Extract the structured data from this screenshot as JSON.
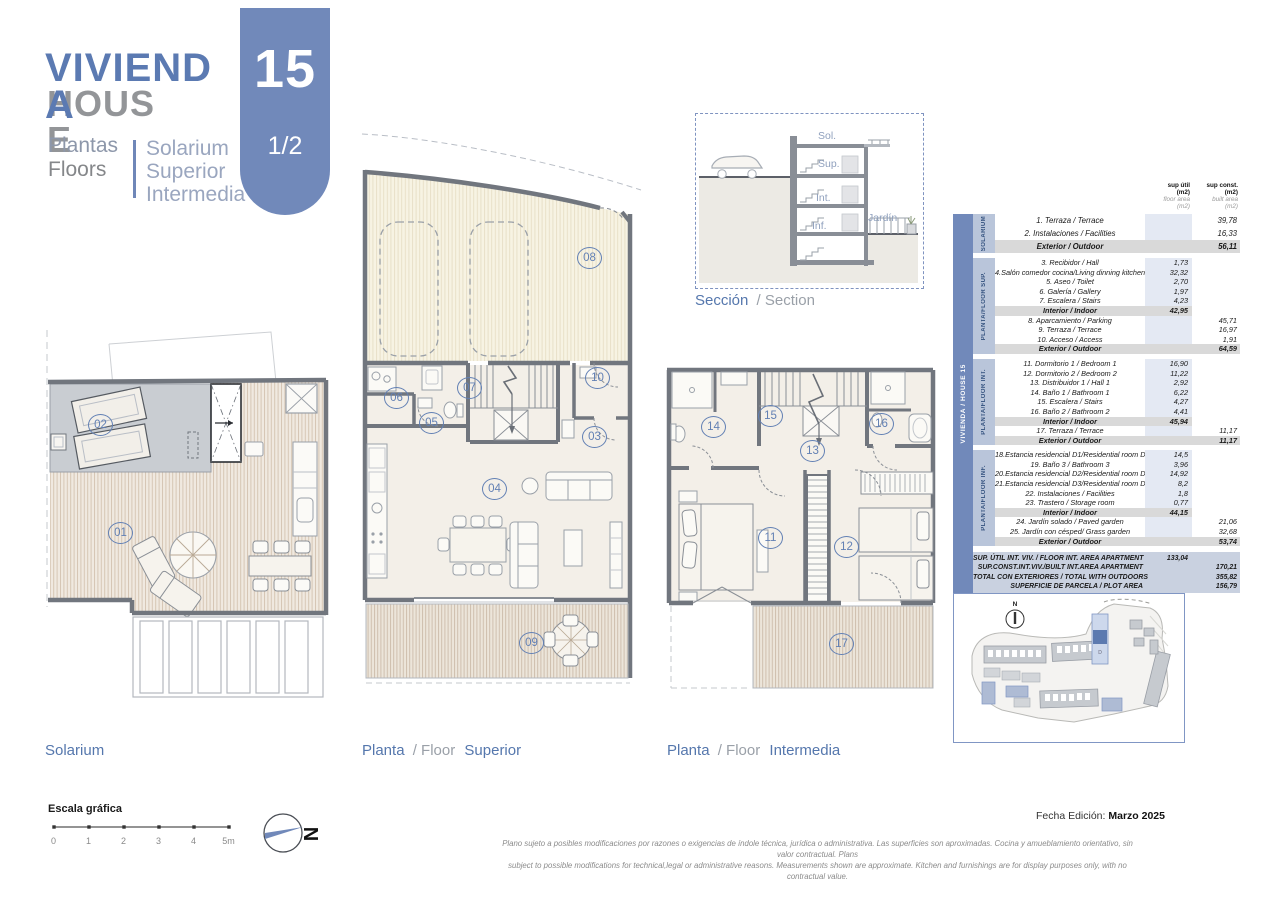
{
  "colors": {
    "accent_blue": "#5b7ab2",
    "tab_blue": "#7189ba",
    "gray_text": "#939598",
    "table_section_blue": "#b9c5da",
    "subtotal_gray": "#d9d9d9",
    "summary_blue": "#c9d1e0",
    "circle_blue": "#6280b4",
    "deck_stripe": "#cfbfae",
    "wall_gray": "#71767e"
  },
  "header": {
    "title_es": "VIVIENDA",
    "title_en": "HOUSE",
    "subtitle_es": "Plantas",
    "subtitle_en": "Floors",
    "floors": [
      "Solarium",
      "Superior",
      "Intermedia"
    ],
    "unit_number": "15",
    "page": "1/2"
  },
  "section_drawing": {
    "labels": {
      "sol": "Sol.",
      "sup": "Sup.",
      "int": "Int.",
      "inf": "Inf.",
      "jardin": "Jardín"
    },
    "caption_es": "Sección",
    "caption_rest": "/ Section"
  },
  "plans": [
    {
      "id": "solarium",
      "caption": {
        "es": "Solarium",
        "mid": "",
        "name": ""
      },
      "circles": [
        {
          "n": "01",
          "x": 65,
          "y": 200
        },
        {
          "n": "02",
          "x": 45,
          "y": 92
        }
      ]
    },
    {
      "id": "superior",
      "caption": {
        "es": "Planta",
        "mid": "/ Floor",
        "name": "Superior"
      },
      "circles": [
        {
          "n": "03",
          "x": 224,
          "y": 300
        },
        {
          "n": "04",
          "x": 124,
          "y": 352
        },
        {
          "n": "05",
          "x": 61,
          "y": 286
        },
        {
          "n": "06",
          "x": 26,
          "y": 261
        },
        {
          "n": "07",
          "x": 99,
          "y": 251
        },
        {
          "n": "08",
          "x": 219,
          "y": 121
        },
        {
          "n": "09",
          "x": 161,
          "y": 506
        },
        {
          "n": "10",
          "x": 227,
          "y": 241
        }
      ]
    },
    {
      "id": "intermedia",
      "caption": {
        "es": "Planta",
        "mid": "/ Floor",
        "name": "Intermedia"
      },
      "circles": [
        {
          "n": "11",
          "x": 95,
          "y": 169
        },
        {
          "n": "12",
          "x": 171,
          "y": 178
        },
        {
          "n": "13",
          "x": 137,
          "y": 82
        },
        {
          "n": "14",
          "x": 38,
          "y": 58
        },
        {
          "n": "15",
          "x": 95,
          "y": 47
        },
        {
          "n": "16",
          "x": 206,
          "y": 55
        },
        {
          "n": "17",
          "x": 166,
          "y": 275
        }
      ]
    }
  ],
  "table": {
    "side_label": "VIVIENDA / HOUSE 15",
    "col_headers": [
      {
        "title": "sup útil",
        "unit": "(m2)",
        "sub": "floor area",
        "sub_unit": "(m2)"
      },
      {
        "title": "sup const.",
        "unit": "(m2)",
        "sub": "built area",
        "sub_unit": "(m2)"
      }
    ],
    "sections": [
      {
        "bar": "SOLARIUM",
        "rows": [
          {
            "l": "1. Terraza / Terrace",
            "u": "",
            "c": "39,78",
            "sub": ""
          },
          {
            "l": "2. Instalaciones / Facilities",
            "u": "",
            "c": "16,33",
            "sub": ""
          },
          {
            "l": "Exterior / Outdoor",
            "u": "",
            "c": "56,11",
            "sub": "ex"
          }
        ]
      },
      {
        "bar": "PLANTA/FLOOR SUP.",
        "rows": [
          {
            "l": "3. Recibidor / Hall",
            "u": "1,73",
            "c": "",
            "sub": ""
          },
          {
            "l": "4.Salón comedor cocina/Living dinning kitchen",
            "u": "32,32",
            "c": "",
            "sub": ""
          },
          {
            "l": "5. Aseo / Toilet",
            "u": "2,70",
            "c": "",
            "sub": ""
          },
          {
            "l": "6. Galería / Gallery",
            "u": "1,97",
            "c": "",
            "sub": ""
          },
          {
            "l": "7. Escalera / Stairs",
            "u": "4,23",
            "c": "",
            "sub": ""
          },
          {
            "l": "Interior / Indoor",
            "u": "42,95",
            "c": "",
            "sub": "in"
          },
          {
            "l": "8. Aparcamiento / Parking",
            "u": "",
            "c": "45,71",
            "sub": ""
          },
          {
            "l": "9. Terraza / Terrace",
            "u": "",
            "c": "16,97",
            "sub": ""
          },
          {
            "l": "10. Acceso / Access",
            "u": "",
            "c": "1,91",
            "sub": ""
          },
          {
            "l": "Exterior / Outdoor",
            "u": "",
            "c": "64,59",
            "sub": "ex"
          }
        ]
      },
      {
        "bar": "PLANTA/FLOOR INT.",
        "rows": [
          {
            "l": "11. Dormitorio 1 / Bedroom 1",
            "u": "16,90",
            "c": "",
            "sub": ""
          },
          {
            "l": "12.  Dormitorio 2 / Bedroom 2",
            "u": "11,22",
            "c": "",
            "sub": ""
          },
          {
            "l": "13. Distribuidor 1 / Hall 1",
            "u": "2,92",
            "c": "",
            "sub": ""
          },
          {
            "l": "14. Baño 1 / Bathroom 1",
            "u": "6,22",
            "c": "",
            "sub": ""
          },
          {
            "l": "15. Escalera / Stairs",
            "u": "4,27",
            "c": "",
            "sub": ""
          },
          {
            "l": "16. Baño 2 / Bathroom 2",
            "u": "4,41",
            "c": "",
            "sub": ""
          },
          {
            "l": "Interior / Indoor",
            "u": "45,94",
            "c": "",
            "sub": "in"
          },
          {
            "l": "17. Terraza / Terrace",
            "u": "",
            "c": "11,17",
            "sub": ""
          },
          {
            "l": "Exterior / Outdoor",
            "u": "",
            "c": "11,17",
            "sub": "ex"
          }
        ]
      },
      {
        "bar": "PLANTA/FLOOR INF.",
        "rows": [
          {
            "l": "18.Estancia residencial D1/Residential room D1",
            "u": "14,5",
            "c": "",
            "sub": ""
          },
          {
            "l": "19. Baño 3 / Bathroom 3",
            "u": "3,96",
            "c": "",
            "sub": ""
          },
          {
            "l": "20.Estancia residencial D2/Residential room D2",
            "u": "14,92",
            "c": "",
            "sub": ""
          },
          {
            "l": "21.Estancia residencial D3/Residential room D3",
            "u": "8,2",
            "c": "",
            "sub": ""
          },
          {
            "l": "22. Instalaciones / Facilities",
            "u": "1,8",
            "c": "",
            "sub": ""
          },
          {
            "l": "23. Trastero / Storage room",
            "u": "0,77",
            "c": "",
            "sub": ""
          },
          {
            "l": "Interior / Indoor",
            "u": "44,15",
            "c": "",
            "sub": "in"
          },
          {
            "l": "24. Jardín solado / Paved garden",
            "u": "",
            "c": "21,06",
            "sub": ""
          },
          {
            "l": "25. Jardín con césped/ Grass garden",
            "u": "",
            "c": "32,68",
            "sub": ""
          },
          {
            "l": "Exterior / Outdoor",
            "u": "",
            "c": "53,74",
            "sub": "ex"
          }
        ]
      }
    ],
    "summary": [
      {
        "l": "SUP. ÚTIL INT. VIV. / FLOOR INT. AREA APARTMENT",
        "u": "133,04",
        "c": ""
      },
      {
        "l": "SUP.CONST.INT.VIV./BUILT INT.AREA APARTMENT",
        "u": "",
        "c": "170,21"
      },
      {
        "l": "TOTAL CON EXTERIORES / TOTAL WITH OUTDOORS",
        "u": "",
        "c": "355,82"
      },
      {
        "l": "SUPERFICIE DE PARCELA / PLOT AREA",
        "u": "",
        "c": "156,79"
      }
    ]
  },
  "siteplan": {
    "north_label": "N",
    "unit_letter": "D"
  },
  "footer": {
    "scale_title": "Escala gráfica",
    "scale_ticks": [
      "0",
      "1",
      "2",
      "3",
      "4",
      "5m"
    ],
    "north_label": "N",
    "disclaimer_line1": "Plano sujeto a posibles modificaciones por razones o exigencias de índole técnica, jurídica o administrativa. Las superficies son aproximadas. Cocina y amueblamiento orientativo, sin valor contractual.   Plans",
    "disclaimer_line2": "subject to possible modifications for technical,legal or administrative reasons. Measurements shown are approximate. Kitchen and furnishings are for display purposes only, with no contractual value.",
    "edition_label": "Fecha Edición:",
    "edition_value": "Marzo 2025"
  }
}
